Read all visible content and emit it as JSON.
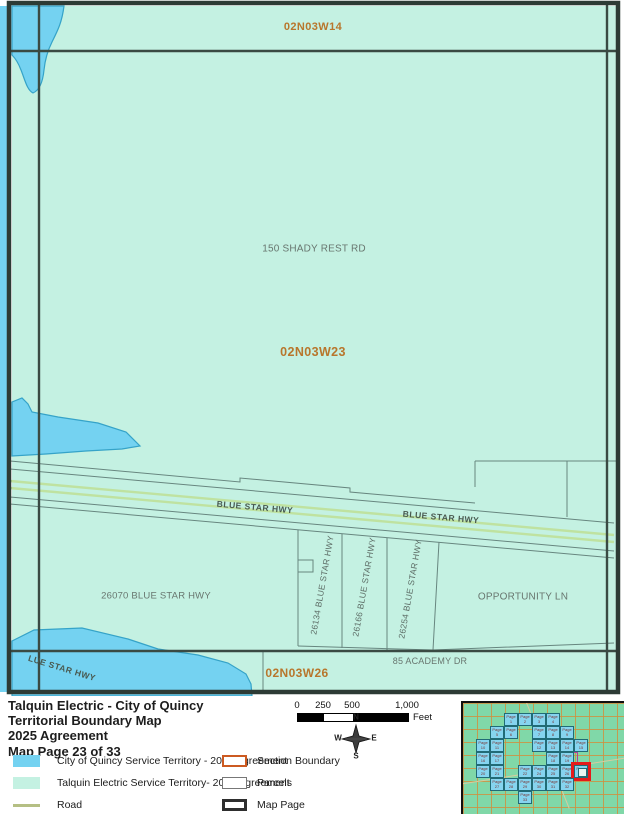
{
  "document": {
    "title_lines": [
      "Talquin Electric - City of Quincy",
      "Territorial Boundary Map",
      "2025 Agreement",
      "Map Page 23 of 33"
    ]
  },
  "colors": {
    "city_blue": "#74d2f1",
    "talquin_teal": "#c4f1e2",
    "road_olive": "#b5bf84",
    "section_boundary_orange": "#cc5a21",
    "parcel_gray": "#777777",
    "map_page_black": "#2e2e2e",
    "section_label_orange": "#b8762c",
    "highlight_red": "#e51a1a"
  },
  "map": {
    "labels": [
      {
        "kind": "section",
        "text": "02N03W14",
        "x": 313,
        "y": 27,
        "size": 11,
        "rot": 0
      },
      {
        "kind": "section",
        "text": "02N03W23",
        "x": 313,
        "y": 352,
        "size": 12.5,
        "rot": 0
      },
      {
        "kind": "section",
        "text": "02N03W26",
        "x": 297,
        "y": 673,
        "size": 12,
        "rot": 0
      },
      {
        "kind": "address",
        "text": "150 SHADY REST RD",
        "x": 314,
        "y": 249,
        "size": 10,
        "rot": 0
      },
      {
        "kind": "address",
        "text": "26070 BLUE STAR HWY",
        "x": 156,
        "y": 596,
        "size": 9.5,
        "rot": 0
      },
      {
        "kind": "address",
        "text": "OPPORTUNITY LN",
        "x": 523,
        "y": 597,
        "size": 10,
        "rot": 0
      },
      {
        "kind": "address",
        "text": "85 ACADEMY DR",
        "x": 430,
        "y": 661,
        "size": 9,
        "rot": 0
      },
      {
        "kind": "road",
        "text": "BLUE STAR HWY",
        "x": 255,
        "y": 507,
        "size": 8.5,
        "rot": 5
      },
      {
        "kind": "road",
        "text": "BLUE STAR HWY",
        "x": 441,
        "y": 517,
        "size": 8.5,
        "rot": 5
      },
      {
        "kind": "road",
        "text": "LUE STAR HWY",
        "x": 62,
        "y": 668,
        "size": 8.5,
        "rot": 17
      },
      {
        "kind": "parcel",
        "text": "26134 BLUE STAR HWY",
        "x": 322,
        "y": 585,
        "size": 8.5,
        "rot": -80
      },
      {
        "kind": "parcel",
        "text": "26166 BLUE STAR HWY",
        "x": 364,
        "y": 587,
        "size": 8.5,
        "rot": -80
      },
      {
        "kind": "parcel",
        "text": "26254 BLUE STAR HWY",
        "x": 410,
        "y": 589,
        "size": 8.5,
        "rot": -80
      }
    ]
  },
  "scale_bar": {
    "ticks": [
      {
        "label": "0",
        "x": 5
      },
      {
        "label": "250",
        "x": 31
      },
      {
        "label": "500",
        "x": 60
      },
      {
        "label": "1,000",
        "x": 115
      }
    ],
    "segments": [
      {
        "kind": "b",
        "w": 26
      },
      {
        "kind": "w",
        "w": 29
      },
      {
        "kind": "b",
        "w": 55
      }
    ],
    "unit": "Feet"
  },
  "compass": {
    "n": "N",
    "s": "S",
    "e": "E",
    "w": "W"
  },
  "legend": {
    "left": [
      {
        "swatch": "city_blue",
        "style": "fill",
        "label": "City of Quincy Service Territory - 2025 Agreement"
      },
      {
        "swatch": "talquin_teal",
        "style": "fill",
        "label": "Talquin Electric Service Territory- 2025 Agreement"
      },
      {
        "swatch": "road_olive",
        "style": "line",
        "label": "Road"
      }
    ],
    "right": [
      {
        "swatch": "section_boundary_orange",
        "border": 2.5,
        "label": "Section Boundary"
      },
      {
        "swatch": "parcel_gray",
        "border": 1.5,
        "label": "Parcels"
      },
      {
        "swatch": "map_page_black",
        "border": 3.5,
        "label": "Map Page"
      }
    ]
  },
  "inset": {
    "highlighted_page": "Page 23",
    "cells": [
      {
        "c": 2,
        "r": 0,
        "label": "Page 1"
      },
      {
        "c": 3,
        "r": 0,
        "label": "Page 2"
      },
      {
        "c": 4,
        "r": 0,
        "label": "Page 3"
      },
      {
        "c": 5,
        "r": 0,
        "label": "Page 4"
      },
      {
        "c": 1,
        "r": 1,
        "label": "Page 5"
      },
      {
        "c": 2,
        "r": 1,
        "label": "Page 6"
      },
      {
        "c": 4,
        "r": 1,
        "label": "Page 7"
      },
      {
        "c": 5,
        "r": 1,
        "label": "Page 8"
      },
      {
        "c": 6,
        "r": 1,
        "label": "Page 9"
      },
      {
        "c": 0,
        "r": 2,
        "label": "Page 10"
      },
      {
        "c": 1,
        "r": 2,
        "label": "Page 11"
      },
      {
        "c": 4,
        "r": 2,
        "label": "Page 12"
      },
      {
        "c": 5,
        "r": 2,
        "label": "Page 13"
      },
      {
        "c": 6,
        "r": 2,
        "label": "Page 14"
      },
      {
        "c": 7,
        "r": 2,
        "label": "Page 15"
      },
      {
        "c": 0,
        "r": 3,
        "label": "Page 16"
      },
      {
        "c": 1,
        "r": 3,
        "label": "Page 17"
      },
      {
        "c": 5,
        "r": 3,
        "label": "Page 18"
      },
      {
        "c": 6,
        "r": 3,
        "label": "Page 19"
      },
      {
        "c": 0,
        "r": 4,
        "label": "Page 20"
      },
      {
        "c": 1,
        "r": 4,
        "label": "Page 21"
      },
      {
        "c": 3,
        "r": 4,
        "label": "Page 22"
      },
      {
        "c": 4,
        "r": 4,
        "label": "Page 24"
      },
      {
        "c": 5,
        "r": 4,
        "label": "Page 25"
      },
      {
        "c": 6,
        "r": 4,
        "label": "Page 26"
      },
      {
        "c": 7,
        "r": 4,
        "label": "Page 23",
        "highlight": true
      },
      {
        "c": 1,
        "r": 5,
        "label": "Page 27"
      },
      {
        "c": 2,
        "r": 5,
        "label": "Page 28"
      },
      {
        "c": 3,
        "r": 5,
        "label": "Page 29"
      },
      {
        "c": 4,
        "r": 5,
        "label": "Page 30"
      },
      {
        "c": 5,
        "r": 5,
        "label": "Page 31"
      },
      {
        "c": 6,
        "r": 5,
        "label": "Page 32"
      },
      {
        "c": 3,
        "r": 6,
        "label": "Page 33"
      }
    ]
  }
}
